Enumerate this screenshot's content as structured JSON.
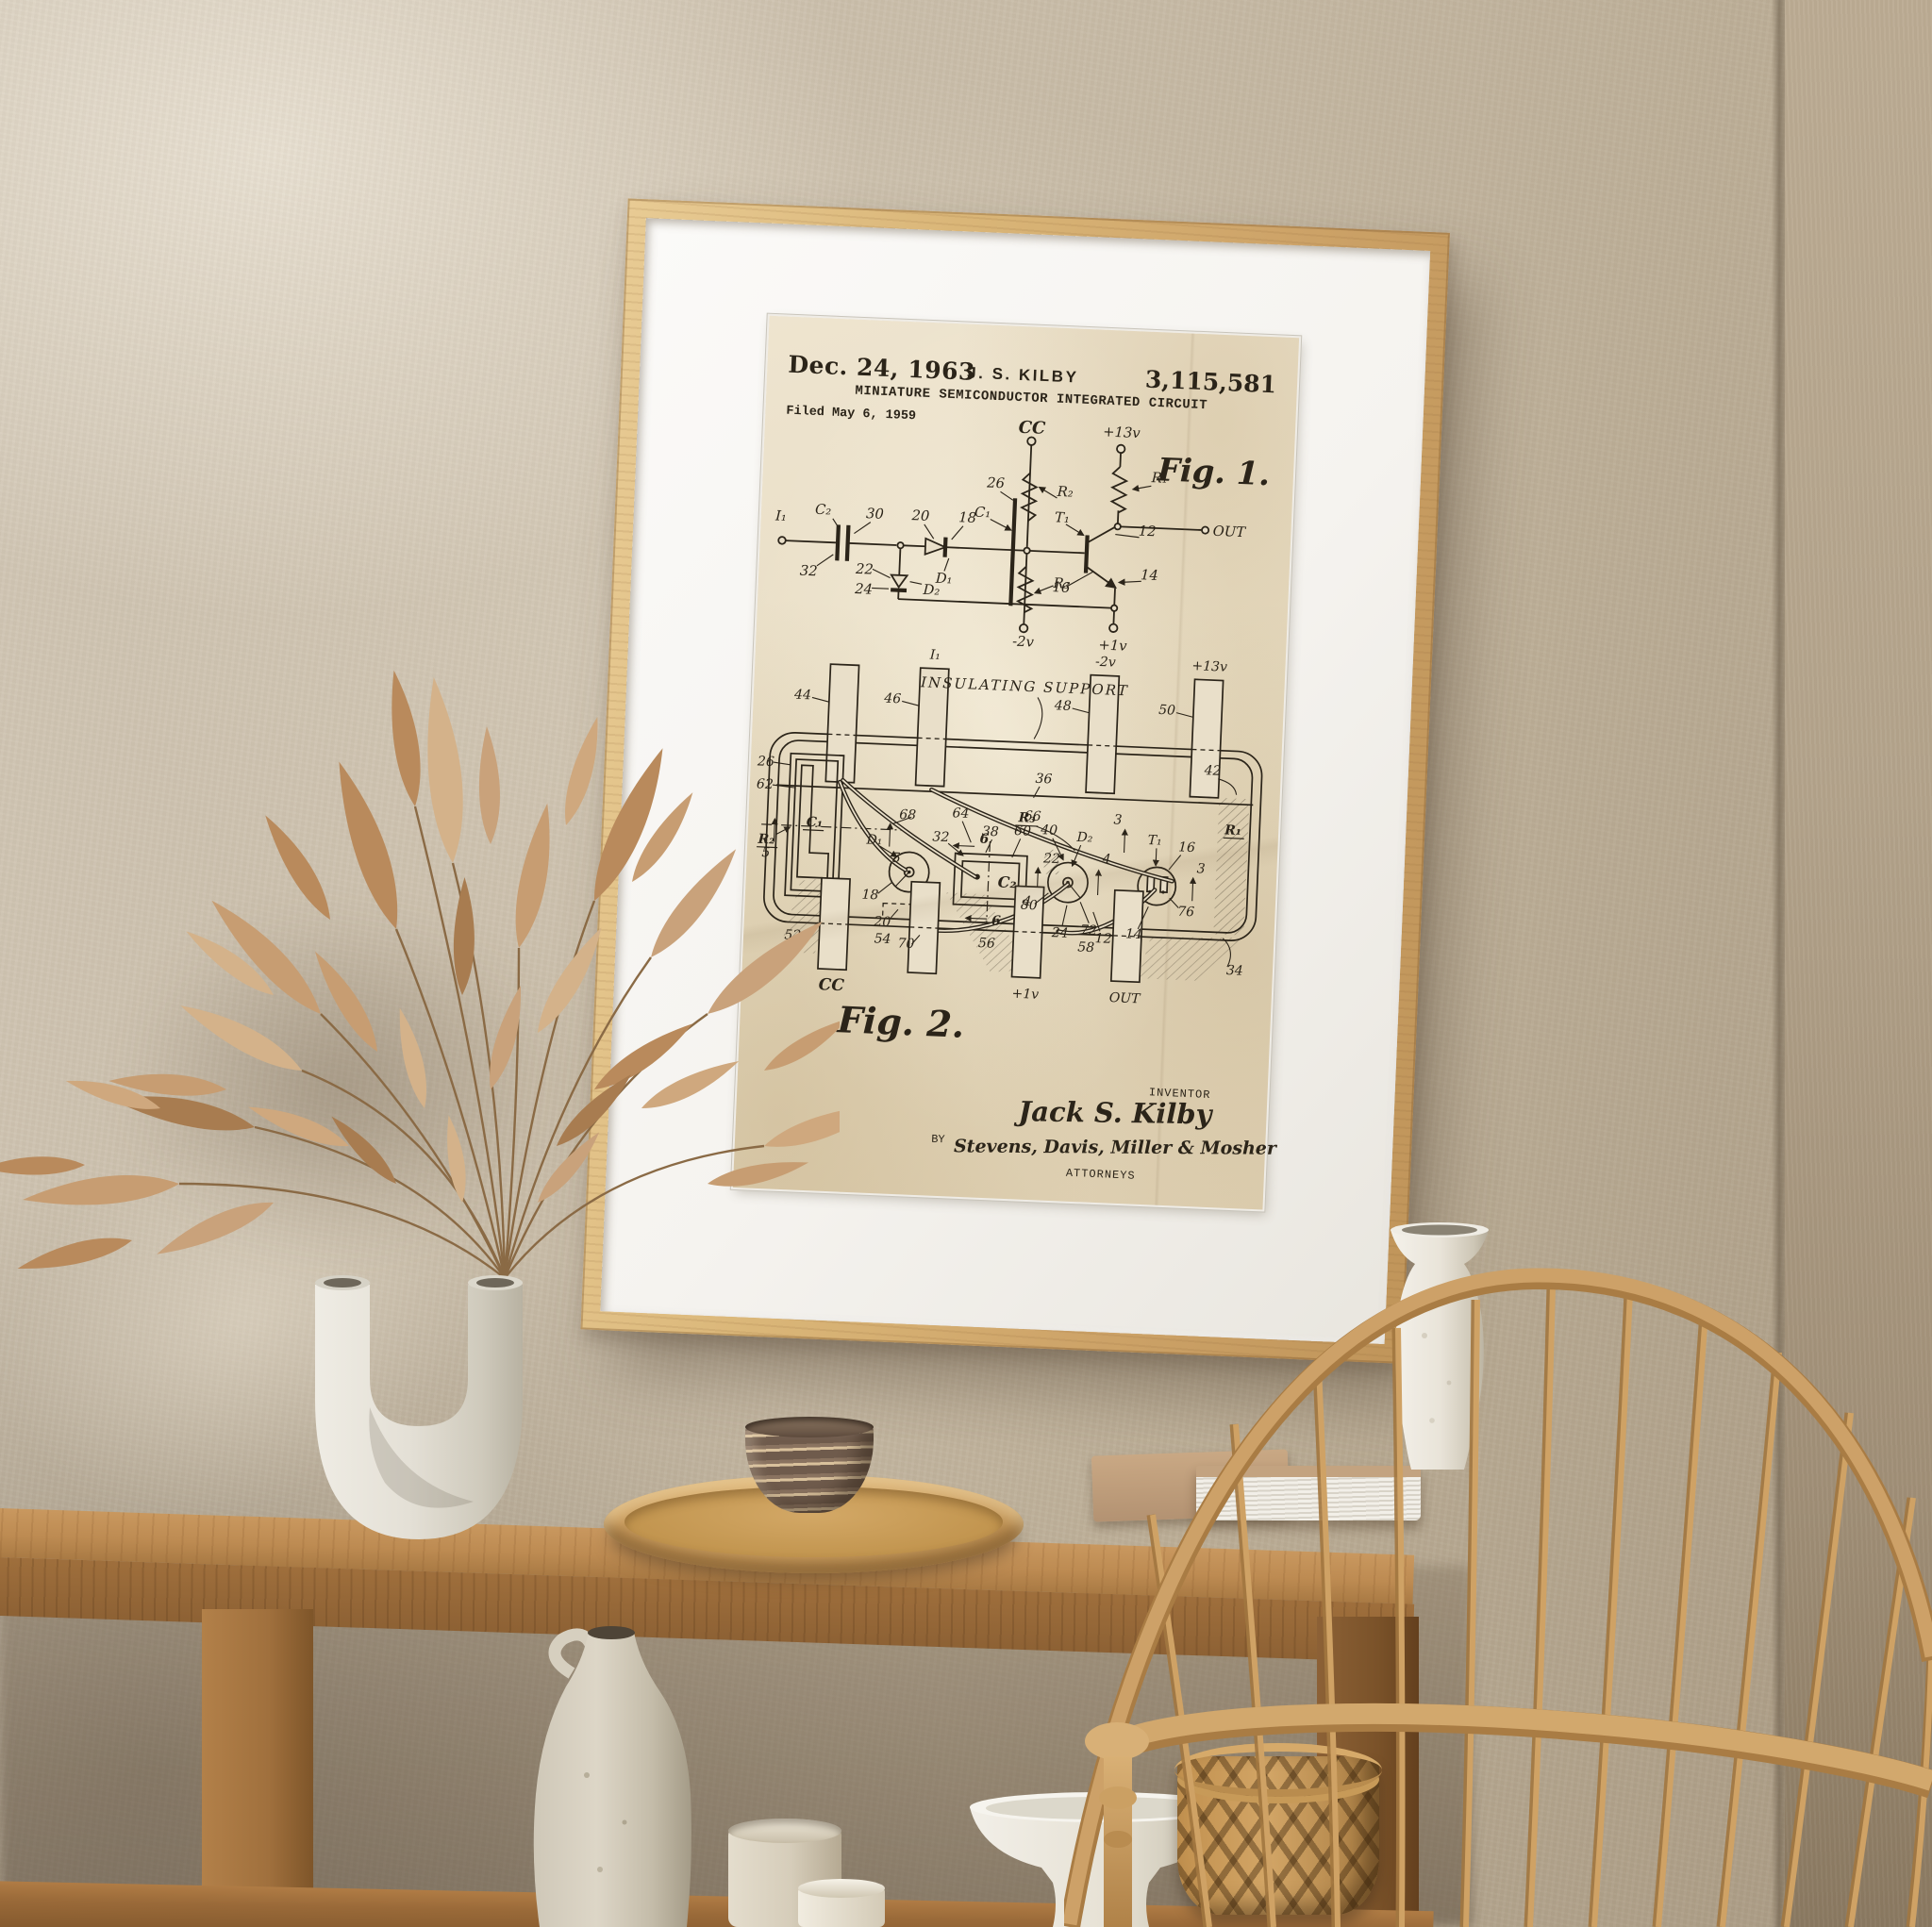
{
  "poster": {
    "header": {
      "date": "Dec. 24, 1963",
      "name": "J. S. KILBY",
      "number": "3,115,581"
    },
    "title": "MINIATURE SEMICONDUCTOR INTEGRATED CIRCUIT",
    "filed": "Filed May 6, 1959",
    "fig1": {
      "caption": "Fig. 1.",
      "terminals": {
        "cc": "CC",
        "p13": "+13v",
        "m2": "-2v",
        "p1": "+1v",
        "out": "OUT"
      },
      "labels": {
        "i1": "I₁",
        "c1": "C₁",
        "c2": "C₂",
        "d1": "D₁",
        "d2": "D₂",
        "r1": "R₁",
        "r2": "R₂",
        "r3": "R₃",
        "t1": "T₁",
        "n12": "12",
        "n14": "14",
        "n16": "16",
        "n18": "18",
        "n20": "20",
        "n22": "22",
        "n24": "24",
        "n26": "26",
        "n30": "30",
        "n32": "32"
      }
    },
    "fig2": {
      "caption": "Fig. 2.",
      "support": "INSULATING SUPPORT",
      "top": {
        "n44": "44",
        "n46": "46",
        "n48": "48",
        "n50": "50",
        "i1": "I₁",
        "m2": "-2v",
        "p13": "+13v"
      },
      "bottom": {
        "n52": "52",
        "n54": "54",
        "n56": "56",
        "n58": "58",
        "cc": "CC",
        "p1": "+1v",
        "out": "OUT",
        "n34": "34"
      },
      "labels": {
        "n36": "36",
        "r3": "R₃",
        "n26": "26",
        "n62": "62",
        "c1": "C₁",
        "r2": "R₂",
        "d1": "D₁",
        "n18": "18",
        "n20": "20",
        "n68": "68",
        "n64": "64",
        "n66": "66",
        "n32": "32",
        "n38": "38",
        "n60": "60",
        "n40": "40",
        "d2": "D₂",
        "n22": "22",
        "c2": "C₂",
        "n80": "80",
        "n70": "70",
        "n24": "24",
        "n72": "72",
        "n12": "12",
        "n42": "42",
        "t1": "T₁",
        "n16": "16",
        "n76": "76",
        "n14": "14",
        "r1": "R₁",
        "s3": "3",
        "s4": "4",
        "s5": "5",
        "s6": "6"
      }
    },
    "footer": {
      "inventor_label": "INVENTOR",
      "inventor_signature": "Jack S. Kilby",
      "by_label": "BY",
      "attorney_signature": "Stevens, Davis, Miller & Mosher",
      "attorneys_label": "ATTORNEYS"
    }
  },
  "colors": {
    "wall": "#c9bda9",
    "wall_right": "#b2a28c",
    "frame_wood": "#d7b277",
    "mat": "#f6f5f2",
    "paper": "#e9dfc9",
    "ink": "#2b2419",
    "table_wood": "#b5824b",
    "foliage": "#c49a6c",
    "ceramic": "#e8e3d8",
    "rattan": "#c89a5d"
  }
}
